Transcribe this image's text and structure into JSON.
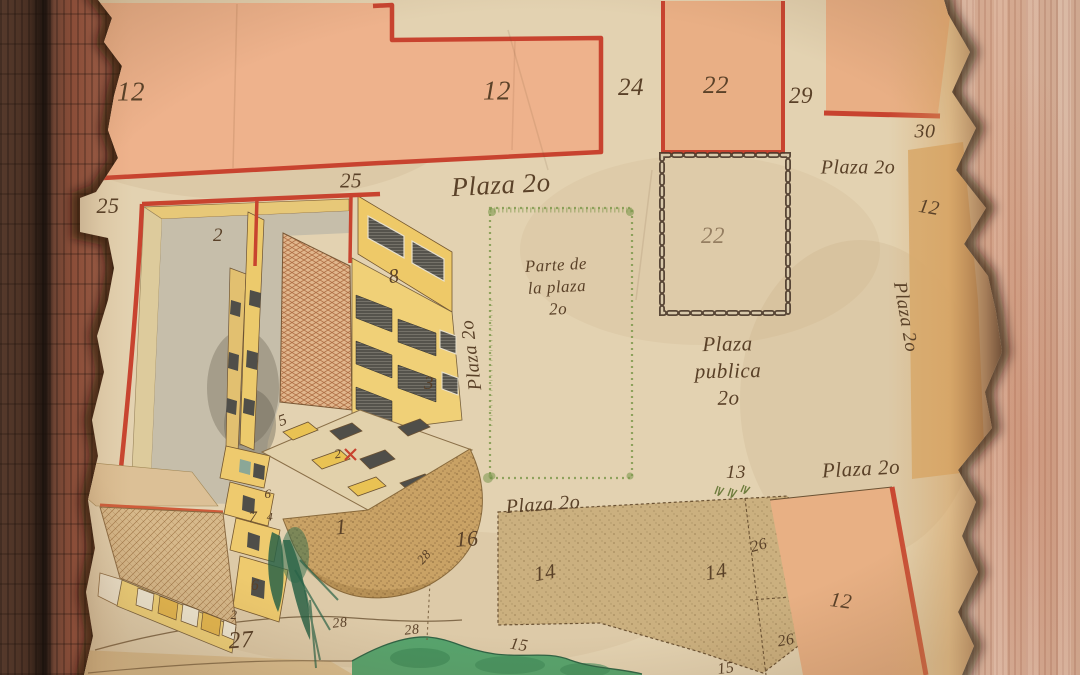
{
  "map": {
    "lot_numbers": [
      {
        "text": "12",
        "x": 131,
        "y": 92,
        "size": 27,
        "rot": 0
      },
      {
        "text": "12",
        "x": 497,
        "y": 91,
        "size": 27,
        "rot": 0
      },
      {
        "text": "24",
        "x": 631,
        "y": 88,
        "size": 25,
        "rot": 0
      },
      {
        "text": "22",
        "x": 716,
        "y": 86,
        "size": 25,
        "rot": 0
      },
      {
        "text": "29",
        "x": 801,
        "y": 96,
        "size": 23,
        "rot": 0
      },
      {
        "text": "30",
        "x": 925,
        "y": 132,
        "size": 20,
        "rot": 0
      },
      {
        "text": "12",
        "x": 929,
        "y": 208,
        "size": 20,
        "rot": 10
      },
      {
        "text": "25",
        "x": 108,
        "y": 206,
        "size": 22,
        "rot": 0
      },
      {
        "text": "25",
        "x": 351,
        "y": 181,
        "size": 21,
        "rot": 0
      },
      {
        "text": "2",
        "x": 218,
        "y": 236,
        "size": 19,
        "rot": 0
      },
      {
        "text": "22",
        "x": 713,
        "y": 236,
        "size": 23,
        "rot": 0,
        "faded": true
      },
      {
        "text": "8",
        "x": 394,
        "y": 277,
        "size": 20,
        "rot": -8
      },
      {
        "text": "3",
        "x": 429,
        "y": 384,
        "size": 19,
        "rot": 0
      },
      {
        "text": "5",
        "x": 283,
        "y": 421,
        "size": 16,
        "rot": -20
      },
      {
        "text": "2",
        "x": 338,
        "y": 454,
        "size": 13,
        "rot": -10
      },
      {
        "text": "6",
        "x": 268,
        "y": 494,
        "size": 13,
        "rot": 0
      },
      {
        "text": "7",
        "x": 253,
        "y": 518,
        "size": 16,
        "rot": 0
      },
      {
        "text": "4",
        "x": 270,
        "y": 517,
        "size": 12,
        "rot": 0
      },
      {
        "text": "1",
        "x": 341,
        "y": 527,
        "size": 22,
        "rot": -5
      },
      {
        "text": "6",
        "x": 255,
        "y": 586,
        "size": 16,
        "rot": 0
      },
      {
        "text": "2",
        "x": 234,
        "y": 615,
        "size": 13,
        "rot": 0
      },
      {
        "text": "27",
        "x": 241,
        "y": 641,
        "size": 24,
        "rot": -4
      },
      {
        "text": "28",
        "x": 424,
        "y": 557,
        "size": 13,
        "rot": -50
      },
      {
        "text": "28",
        "x": 340,
        "y": 624,
        "size": 14,
        "rot": -6
      },
      {
        "text": "28",
        "x": 412,
        "y": 631,
        "size": 14,
        "rot": -6
      },
      {
        "text": "16",
        "x": 467,
        "y": 539,
        "size": 22,
        "rot": -4
      },
      {
        "text": "15",
        "x": 519,
        "y": 645,
        "size": 17,
        "rot": 10
      },
      {
        "text": "15",
        "x": 726,
        "y": 669,
        "size": 16,
        "rot": -8
      },
      {
        "text": "13",
        "x": 736,
        "y": 473,
        "size": 19,
        "rot": 0
      },
      {
        "text": "14",
        "x": 545,
        "y": 573,
        "size": 21,
        "rot": -10
      },
      {
        "text": "14",
        "x": 716,
        "y": 572,
        "size": 21,
        "rot": -10
      },
      {
        "text": "26",
        "x": 759,
        "y": 546,
        "size": 16,
        "rot": -15
      },
      {
        "text": "26",
        "x": 786,
        "y": 641,
        "size": 16,
        "rot": -10
      },
      {
        "text": "12",
        "x": 841,
        "y": 601,
        "size": 21,
        "rot": 8
      }
    ],
    "street_labels": [
      {
        "text": "Plaza 2o",
        "x": 501,
        "y": 185,
        "size": 27,
        "rot": -3
      },
      {
        "text": "Plaza 2o",
        "x": 858,
        "y": 168,
        "size": 20,
        "rot": 0
      },
      {
        "text": "Plaza 2o",
        "x": 905,
        "y": 317,
        "size": 19,
        "rot": 80
      },
      {
        "text": "Plaza 2o",
        "x": 472,
        "y": 355,
        "size": 19,
        "rot": -97
      },
      {
        "text": "Plaza 2o",
        "x": 543,
        "y": 505,
        "size": 20,
        "rot": -4
      },
      {
        "text": "Plaza 2o",
        "x": 861,
        "y": 469,
        "size": 21,
        "rot": -3
      }
    ],
    "inscriptions": [
      {
        "lines": [
          "Parte de",
          "la plaza",
          "2o"
        ],
        "x": 557,
        "y": 287,
        "size": 17,
        "rot": -3
      },
      {
        "lines": [
          "Plaza",
          "publica",
          "2o"
        ],
        "x": 728,
        "y": 371,
        "size": 21,
        "rot": -1
      }
    ]
  },
  "colors": {
    "ink": "#5a4128",
    "lot_border_red": "#c8432f",
    "lot_fill_orange": "#ecb28c",
    "building_yellow": "#f0d077",
    "plaza_border_green": "#7d9a4c",
    "grass_green": "#56a46d",
    "parchment": "#e3d2b1",
    "wood_frame_dark": "#5a3a2b",
    "wood_panel_light": "#d3ac97",
    "chain_border": "#4a382a"
  }
}
